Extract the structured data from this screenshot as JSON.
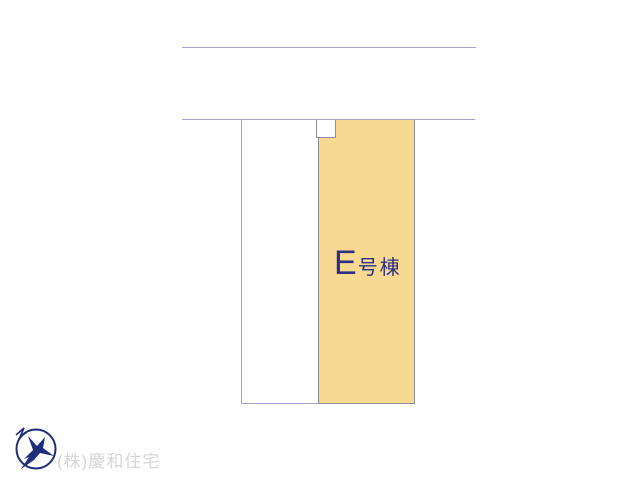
{
  "colors": {
    "background": "#ffffff",
    "plot_fill": "#f8d992",
    "plot_stroke": "#8e8d9e",
    "neighbor_stroke": "#a39fce",
    "road_line": "#a5a4c6",
    "label_text": "#2e2e82",
    "company_text": "#d7d7d7",
    "logo": "#1f2d7a"
  },
  "plan": {
    "building_label": {
      "main": "E",
      "suffix": "号棟"
    }
  },
  "footer": {
    "company_name": "(株)慶和住宅",
    "logo_icon": "bird-logo-icon"
  }
}
